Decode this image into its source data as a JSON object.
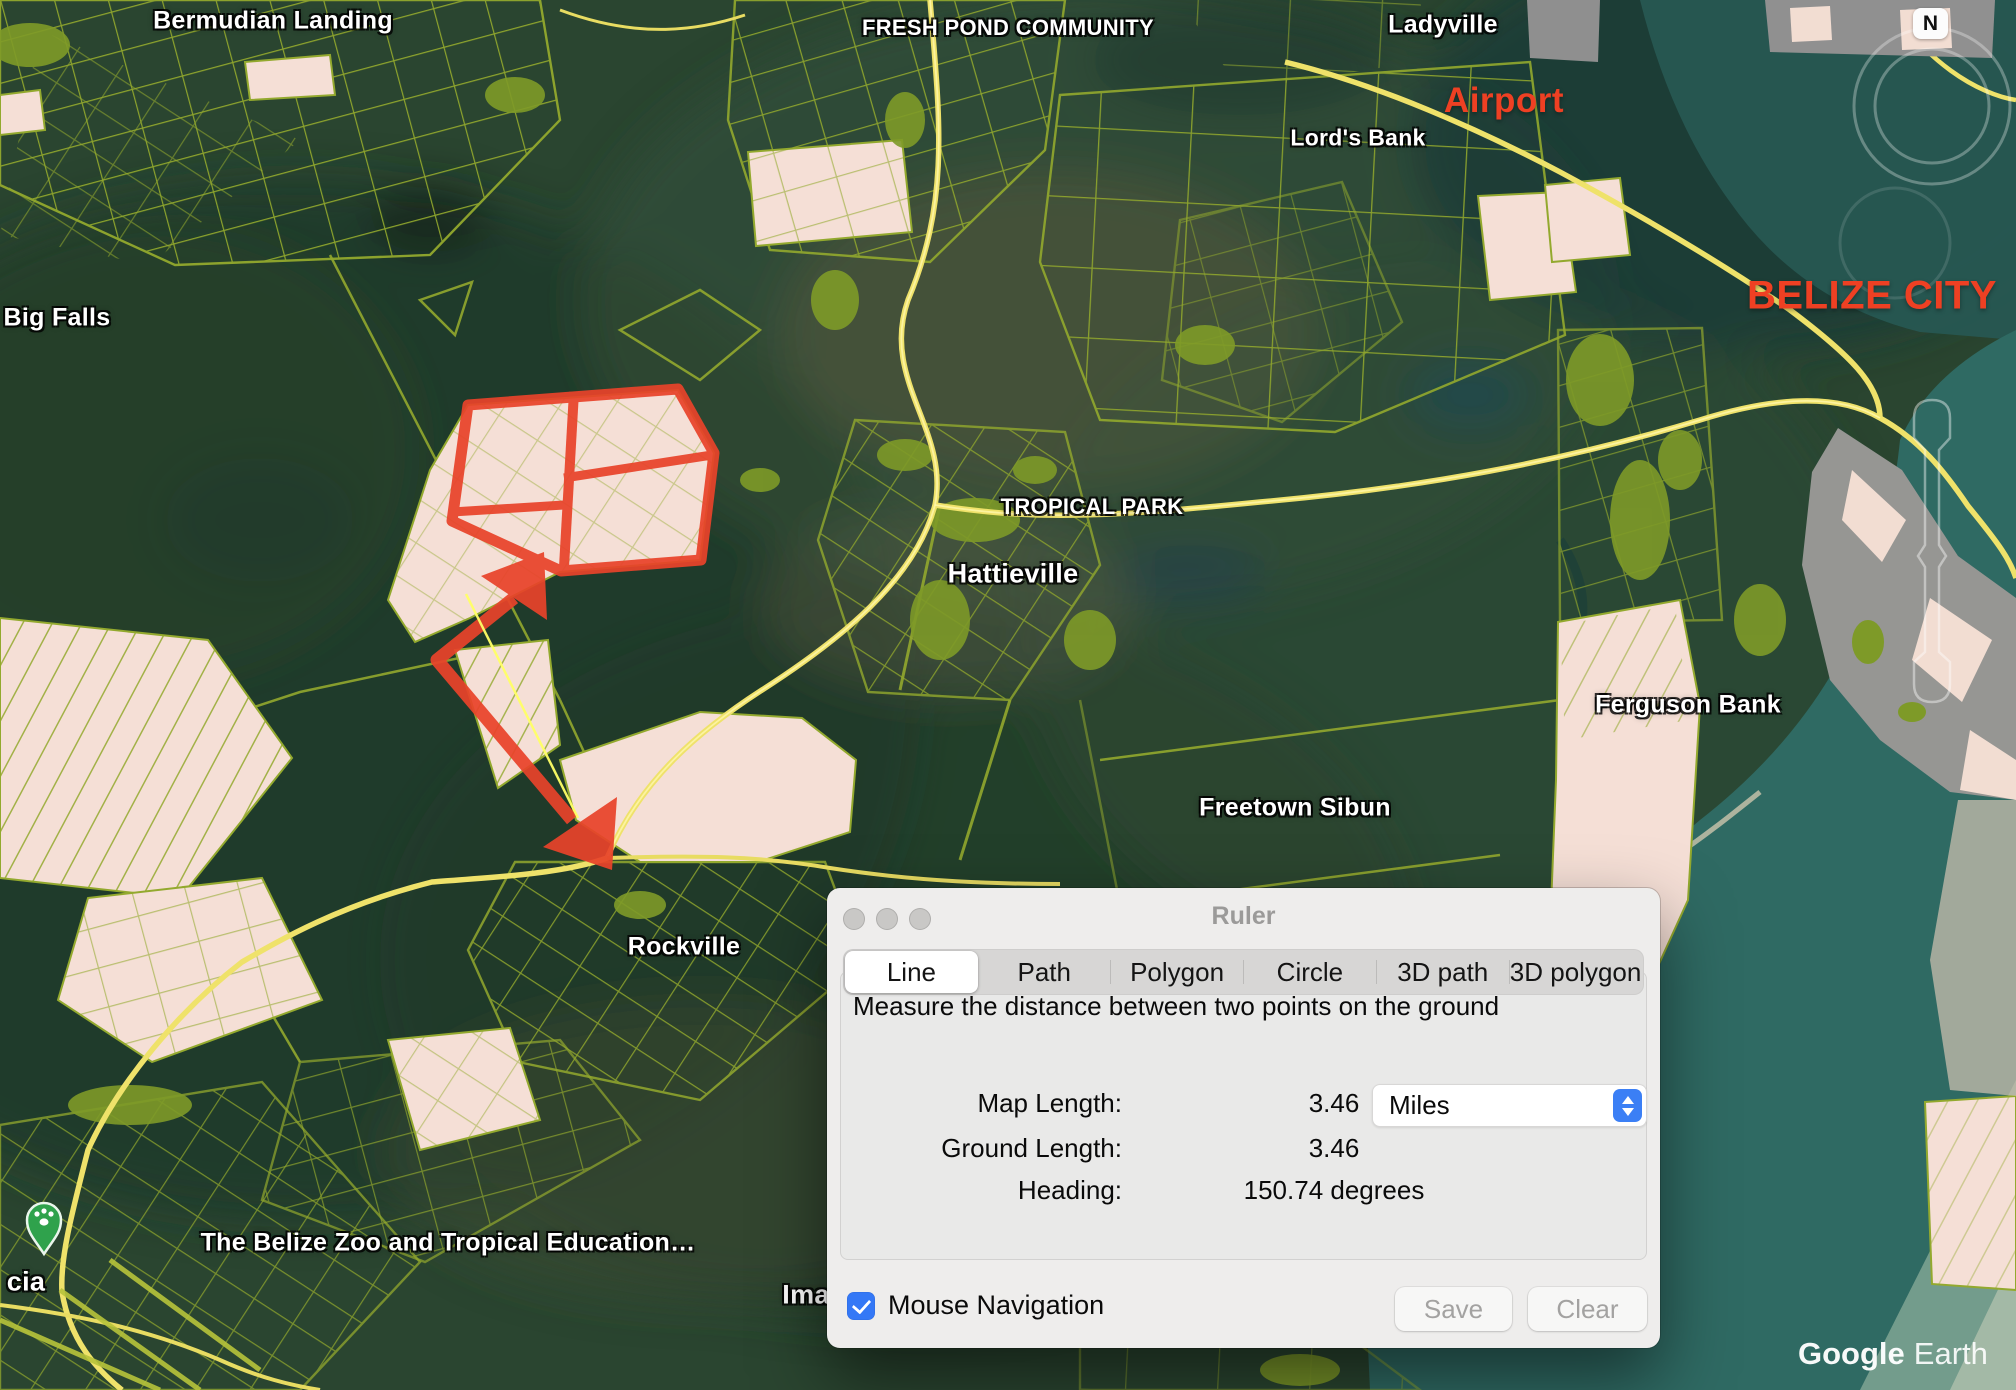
{
  "map": {
    "labels": [
      {
        "text": "Bermudian Landing",
        "x": 273,
        "y": 21,
        "size": 25
      },
      {
        "text": "FRESH POND COMMUNITY",
        "x": 1008,
        "y": 28,
        "size": 22
      },
      {
        "text": "Ladyville",
        "x": 1443,
        "y": 25,
        "size": 25
      },
      {
        "text": "Lord's Bank",
        "x": 1358,
        "y": 138,
        "size": 23
      },
      {
        "text": "Big Falls",
        "x": 57,
        "y": 318,
        "size": 25
      },
      {
        "text": "TROPICAL PARK",
        "x": 1092,
        "y": 507,
        "size": 22
      },
      {
        "text": "Hattieville",
        "x": 1013,
        "y": 574,
        "size": 27
      },
      {
        "text": "Ferguson Bank",
        "x": 1688,
        "y": 705,
        "size": 25
      },
      {
        "text": "Freetown Sibun",
        "x": 1295,
        "y": 808,
        "size": 25
      },
      {
        "text": "Rockville",
        "x": 684,
        "y": 947,
        "size": 25
      },
      {
        "text": "The Belize Zoo and Tropical Education…",
        "x": 448,
        "y": 1243,
        "size": 25
      },
      {
        "text": "cia",
        "x": 26,
        "y": 1282,
        "size": 27
      },
      {
        "text": "Ima",
        "x": 806,
        "y": 1295,
        "size": 27
      }
    ],
    "red_labels": [
      {
        "text": "Airport",
        "x": 1504,
        "y": 101,
        "size": 35
      },
      {
        "text": "BELIZE CITY",
        "x": 1872,
        "y": 296,
        "size": 40
      }
    ],
    "watermark": {
      "brand": "Google",
      "product": "Earth"
    },
    "compass_n": "N"
  },
  "dialog": {
    "title": "Ruler",
    "tabs": [
      {
        "label": "Line",
        "selected": true
      },
      {
        "label": "Path",
        "selected": false
      },
      {
        "label": "Polygon",
        "selected": false
      },
      {
        "label": "Circle",
        "selected": false
      },
      {
        "label": "3D path",
        "selected": false
      },
      {
        "label": "3D polygon",
        "selected": false
      }
    ],
    "description": "Measure the distance between two points on the ground",
    "rows": [
      {
        "label": "Map Length:",
        "value": "3.46"
      },
      {
        "label": "Ground Length:",
        "value": "3.46"
      },
      {
        "label": "Heading:",
        "value": "150.74 degrees"
      }
    ],
    "unit": "Miles",
    "checkbox_label": "Mouse Navigation",
    "checkbox_checked": true,
    "save_label": "Save",
    "clear_label": "Clear"
  },
  "colors": {
    "accent_blue": "#3b7ff5",
    "annotation_red": "#e8432a",
    "parcel_olive": "#93a92e",
    "parcel_pink": "#f5dfd6",
    "road_yellow": "#efe26a",
    "label_red": "#ee4023",
    "water_teal": "#2f6a63"
  }
}
